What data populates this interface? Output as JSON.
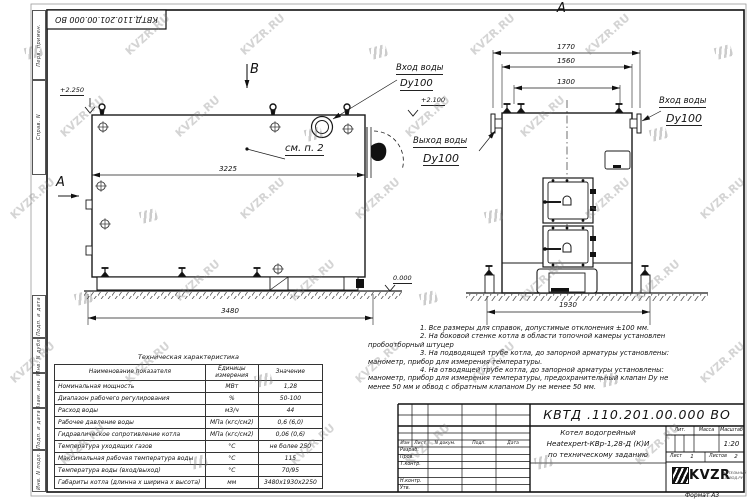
{
  "watermark": {
    "text": "KVZR.RU"
  },
  "frame": {
    "top_designation": "КВТД.110.201.00.000  ВО",
    "margin_labels": [
      "Перв. примен.",
      "Справ. N",
      "Подп. и дата",
      "Инв. N дубл.",
      "Взам. инв. N",
      "Подп. и дата",
      "Инв. N подл."
    ],
    "format_note": "Формат   А3"
  },
  "side_view": {
    "view_label": "В",
    "section_label": "А",
    "elev_top": "+2.250",
    "elev_ground": "0.000",
    "dim_width_inner": "3225",
    "dim_width_overall": "3480",
    "callout": "см. п. 2",
    "inlet": {
      "line1": "Вход воды",
      "line2": "Dy100"
    }
  },
  "front_view": {
    "view_label": "А",
    "elev": "+2.100",
    "dim_1": "1770",
    "dim_2": "1560",
    "dim_3": "1300",
    "dim_overall": "1930",
    "inlet": {
      "line1": "Вход воды",
      "line2": "Dy100"
    },
    "outlet": {
      "line1": "Выход воды",
      "line2": "Dy100"
    }
  },
  "notes": [
    "1. Все размеры для справок, допустимые отклонения  ±100 мм.",
    "2. На боковой стенке котла в области топочной камеры установлен пробоотборный штуцер",
    "3. На подводящей трубе котла, до запорной арматуры установлены: манометр, прибор для измерения температуры.",
    "4. На отводящей трубе котла, до запорной арматуры установлены: манометр, прибор для измерения температуры, предохранительный клапан Dу не менее 50 мм и обвод с обратным клапаном Dу не менее 50 мм."
  ],
  "spec_table": {
    "title": "Техническая характеристика",
    "headers": [
      "Наименование показателя",
      "Единицы измерения",
      "Значение"
    ],
    "rows": [
      [
        "Номинальная мощность",
        "МВт",
        "1,28"
      ],
      [
        "Диапазон рабочего регулирования",
        "%",
        "50-100"
      ],
      [
        "Расход воды",
        "м3/ч",
        "44"
      ],
      [
        "Рабочее давление воды",
        "МПа (кгс/см2)",
        "0,6 (6,0)"
      ],
      [
        "Гидравлическое сопротивление котла",
        "МПа (кгс/см2)",
        "0,06 (0,6)"
      ],
      [
        "Температура уходящих газов",
        "°С",
        "не более 250"
      ],
      [
        "Максимальная рабочая температура воды",
        "°С",
        "115"
      ],
      [
        "Температура воды (вход/выход)",
        "°С",
        "70/95"
      ],
      [
        "Габариты котла (длинна х ширина х высота)",
        "мм",
        "3480х1930х2250"
      ]
    ]
  },
  "title_block": {
    "designation": "КВТД .110.201.00.000  ВО",
    "name_lines": [
      "Котел водогрейный",
      "Heatexpert-КВр-1,28-Д  (К)И",
      "по техническому заданию"
    ],
    "header_cells": [
      "Изм",
      "Лист",
      "N докум.",
      "Подп.",
      "Дата"
    ],
    "row_labels": [
      "Разраб.",
      "Пров.",
      "Т.контр.",
      "Н.контр.",
      "Утв."
    ],
    "lit_label": "Лит.",
    "mass_label": "Масса",
    "scale_label": "Масштаб",
    "scale_value": "1:20",
    "sheet_label": "Лист",
    "sheet_value": "1",
    "sheets_label": "Листов",
    "sheets_value": "2",
    "logo_text": "KVZR",
    "logo_sub1": "КОТЕЛЬНЫЙ",
    "logo_sub2": "ЗАВОД.РУ"
  }
}
